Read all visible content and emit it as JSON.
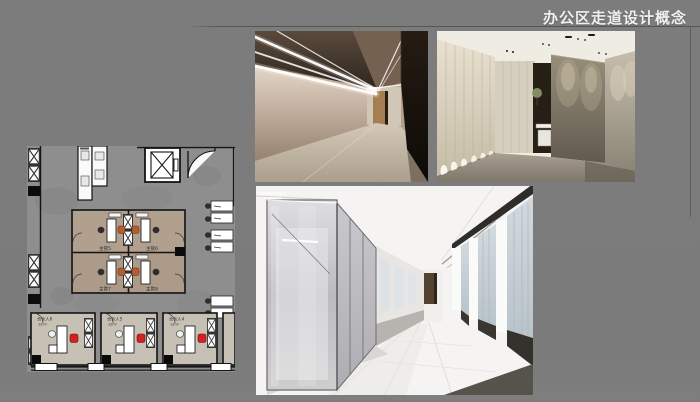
{
  "slide": {
    "title": "办公区走道设计概念",
    "background_color": "#7b7b7b",
    "title_color": "#f0f0f0",
    "rule_color": "#5a5a5a"
  },
  "floor_plan": {
    "manager_rooms": [
      {
        "label": "主管5"
      },
      {
        "label": "主管6"
      },
      {
        "label": "主管7"
      },
      {
        "label": "主管8"
      }
    ],
    "partner_rooms": [
      {
        "label": "合伙人6",
        "area": "12m²"
      },
      {
        "label": "合伙人5",
        "area": "12m²"
      },
      {
        "label": "合伙人4",
        "area": "12m²"
      }
    ],
    "colors": {
      "floor": "#8e8e8e",
      "wall": "#141414",
      "manager_room_fill": "#b2a08e",
      "partner_room_fill": "#c7c0b4",
      "manager_chair": "#b75c2e",
      "partner_chair": "#d32020"
    }
  },
  "photos": {
    "led_corridor": {
      "wall": "#a18d7a",
      "dark_wall": "#17120e",
      "light": "#ffffff"
    },
    "concrete_lobby": {
      "panel_wall": "#ddd5c3",
      "concrete": "#8a8271",
      "floor": "#9a9286"
    },
    "glass_corridor": {
      "glass": "#c3c2c7",
      "floor": "#f0efed",
      "window": "#c9d2d8",
      "sill": "#3a3733"
    }
  }
}
